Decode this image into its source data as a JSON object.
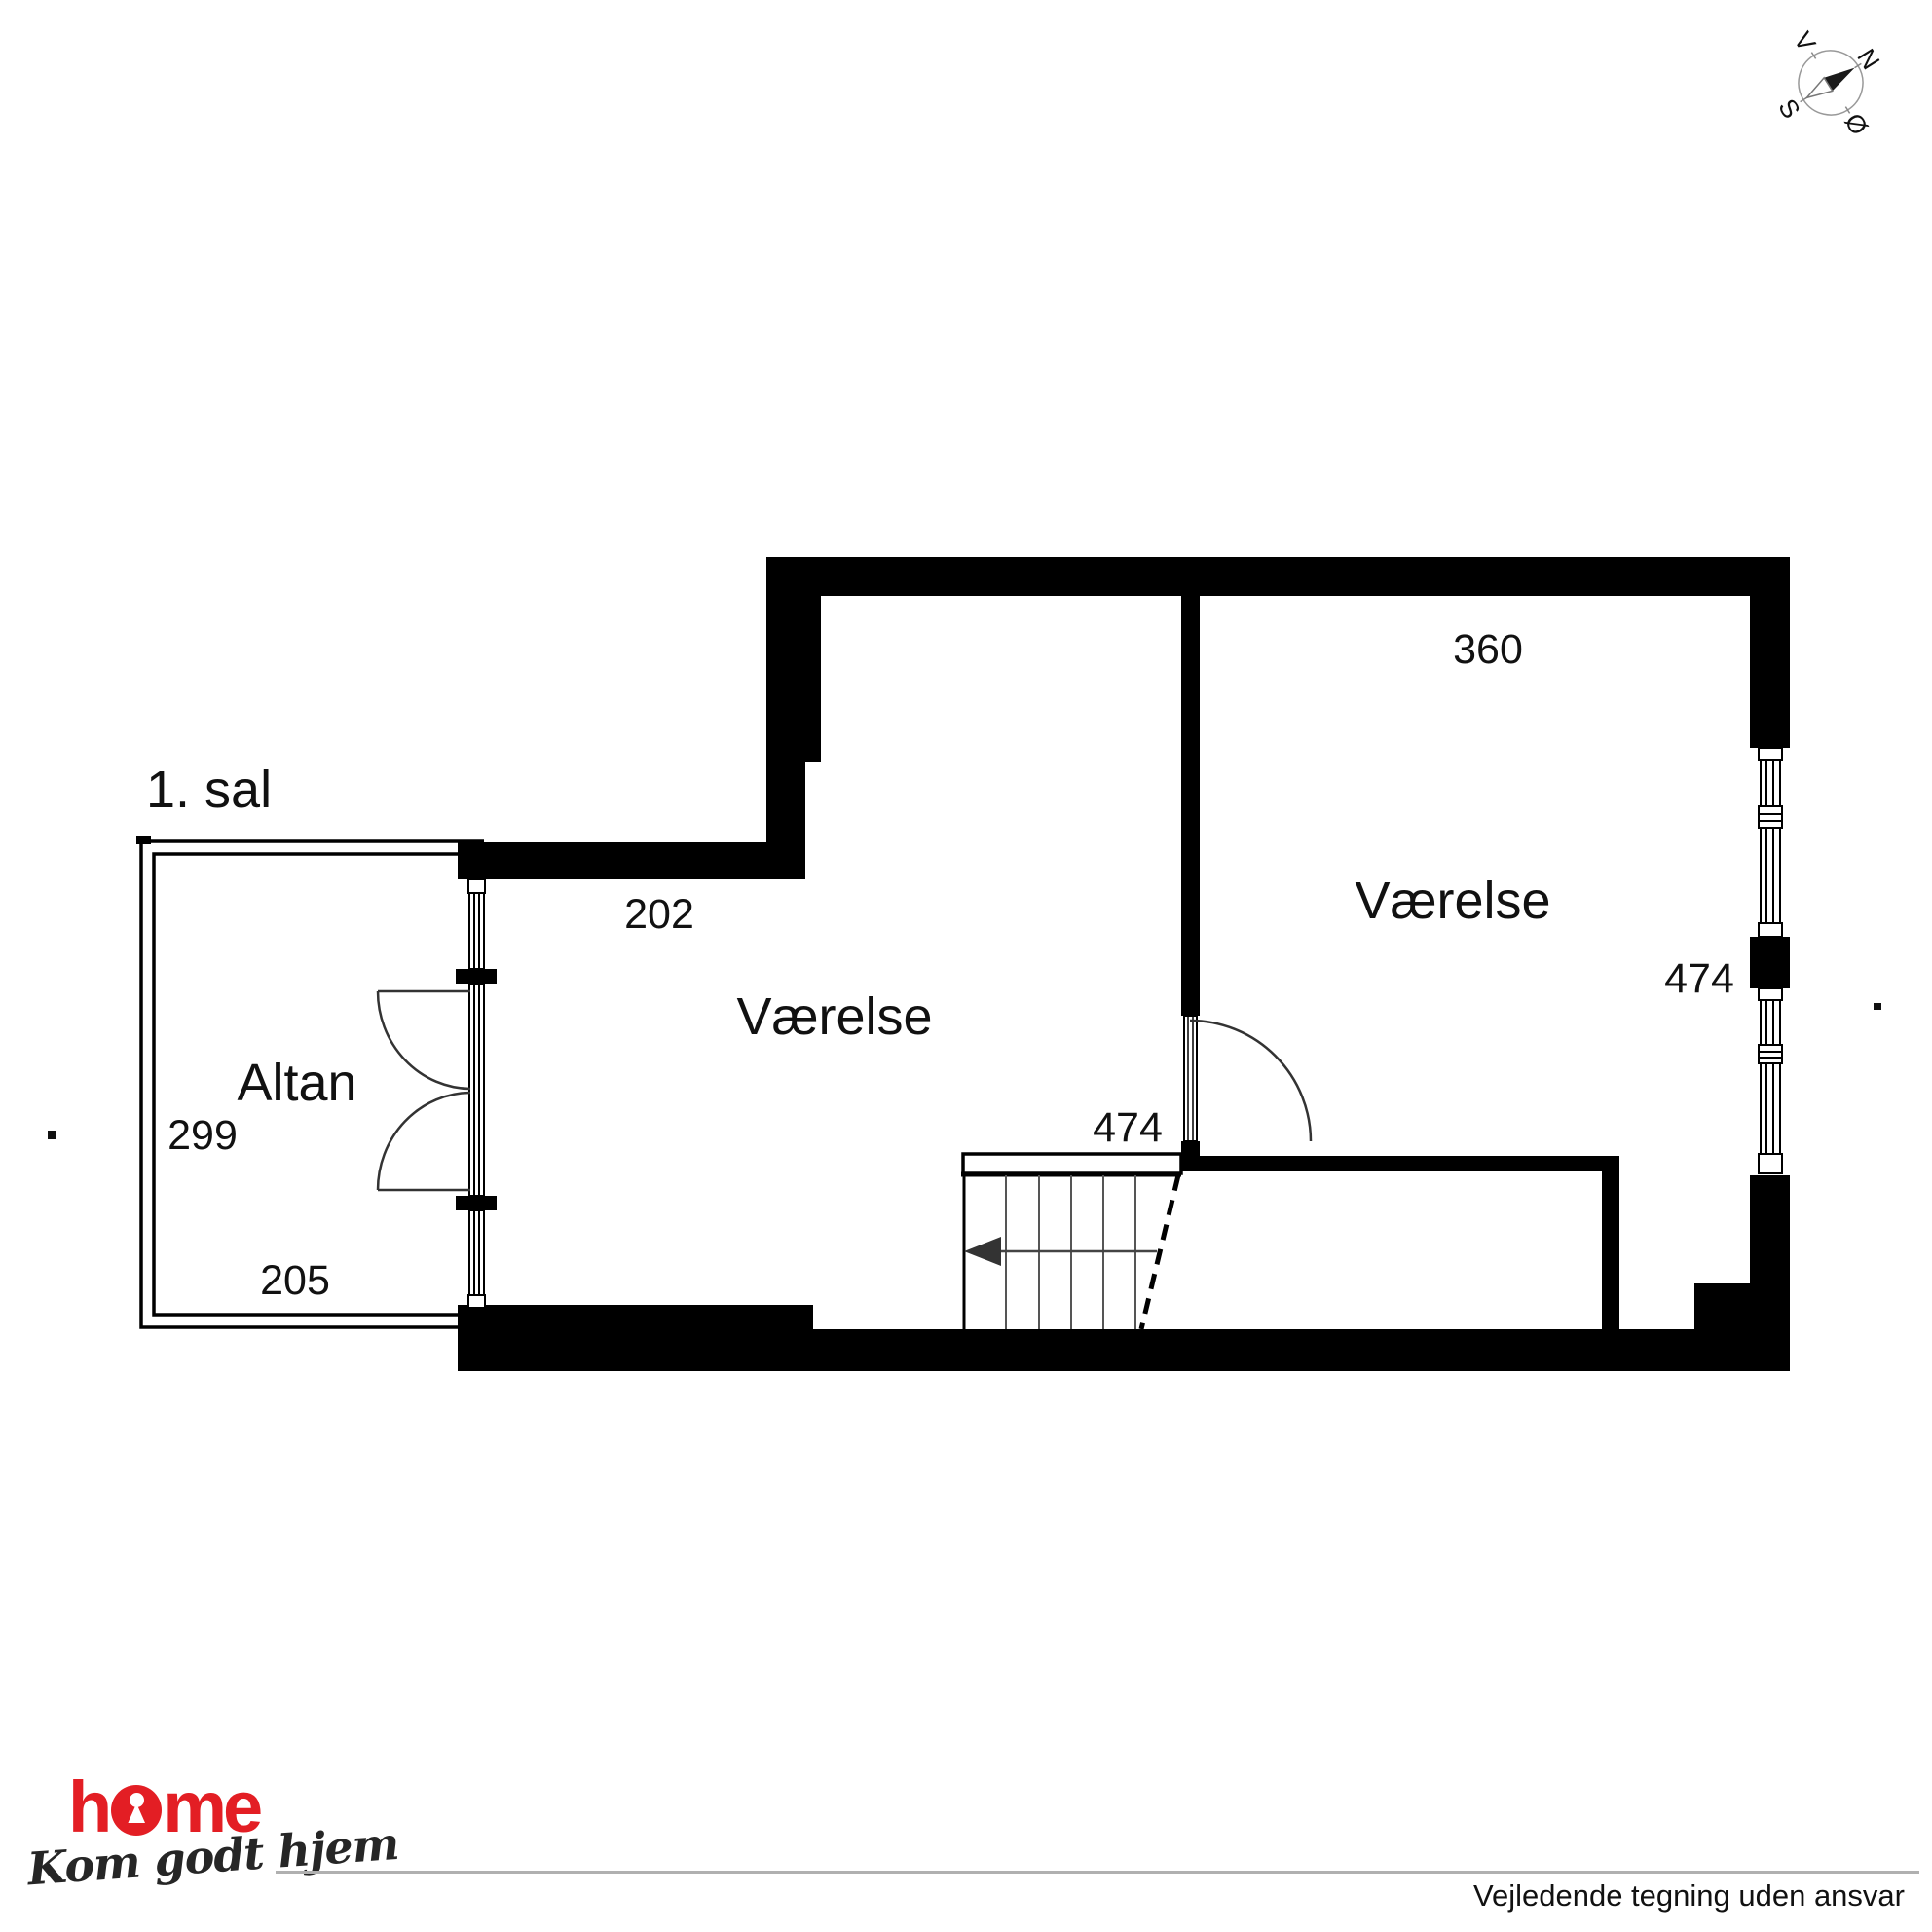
{
  "plan": {
    "floor_label": "1. sal",
    "room_left": "Værelse",
    "room_right": "Værelse",
    "balcony_label": "Altan",
    "dims": {
      "top": "360",
      "upper_left": "202",
      "center": "474",
      "right": "474",
      "balcony_side": "299",
      "balcony_bottom": "205"
    }
  },
  "compass": {
    "n": "N",
    "e": "Ø",
    "s": "S",
    "w": "V"
  },
  "footer": {
    "logo_h": "h",
    "logo_me": "me",
    "tagline": "Kom godt hjem",
    "disclaimer": "Vejledende tegning uden ansvar"
  },
  "colors": {
    "brand_red": "#e31e24",
    "wall_black": "#000000",
    "rule_gray": "#b0b0b0"
  }
}
